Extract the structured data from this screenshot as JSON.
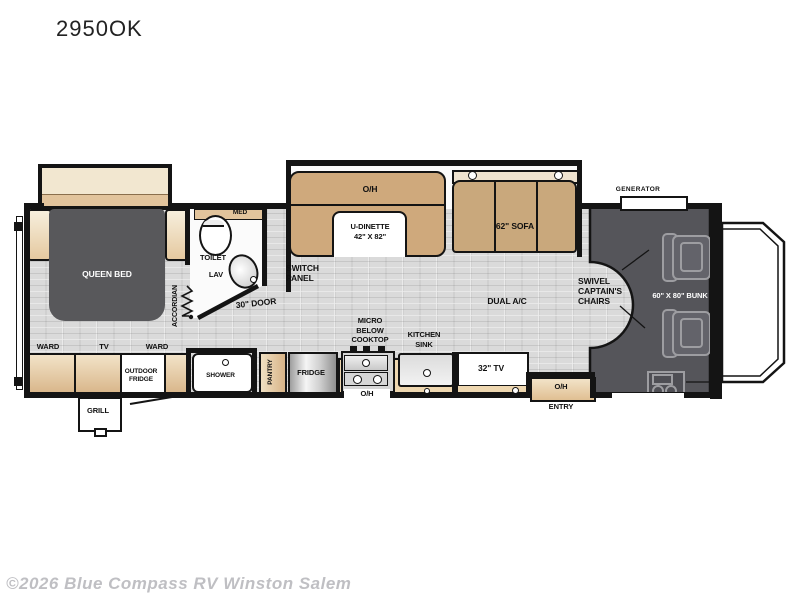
{
  "page": {
    "title": "2950OK",
    "watermark": "©2026 Blue Compass RV Winston Salem"
  },
  "colors": {
    "furniture_tan": "#cfa97c",
    "cabinet_cream": "#f2e7d0",
    "counter_tan": "#eed7b0",
    "cab_dark_gray": "#55555a",
    "bed_dark_gray": "#58585b",
    "floor_gray": "#dadada",
    "wall_black": "#141414",
    "watermark_gray": "#bfbfc3"
  },
  "labels": {
    "generator": "GENERATOR",
    "oh": "O/H",
    "u_dinette": "U-DINETTE\n42\" X 82\"",
    "sofa_62": "62\" SOFA",
    "queen_bed": "QUEEN BED",
    "accordian": "ACCORDIAN",
    "med": "MED",
    "toilet": "TOILET",
    "lav": "LAV",
    "switch_panel": "SWITCH\nPANEL",
    "door_30": "30\" DOOR",
    "dual_ac": "DUAL A/C",
    "swivel_chairs": "SWIVEL\nCAPTAIN'S\nCHAIRS",
    "bunk_60x80": "60\" X 80\" BUNK",
    "ward": "WARD",
    "tv": "TV",
    "outdoor_fridge": "OUTDOOR\nFRIDGE",
    "grill": "GRILL",
    "shower": "SHOWER",
    "pantry": "PANTRY",
    "fridge": "FRIDGE",
    "micro_below_cooktop": "MICRO\nBELOW\nCOOKTOP",
    "kitchen_sink": "KITCHEN\nSINK",
    "tv_32": "32\" TV",
    "entry": "ENTRY"
  }
}
